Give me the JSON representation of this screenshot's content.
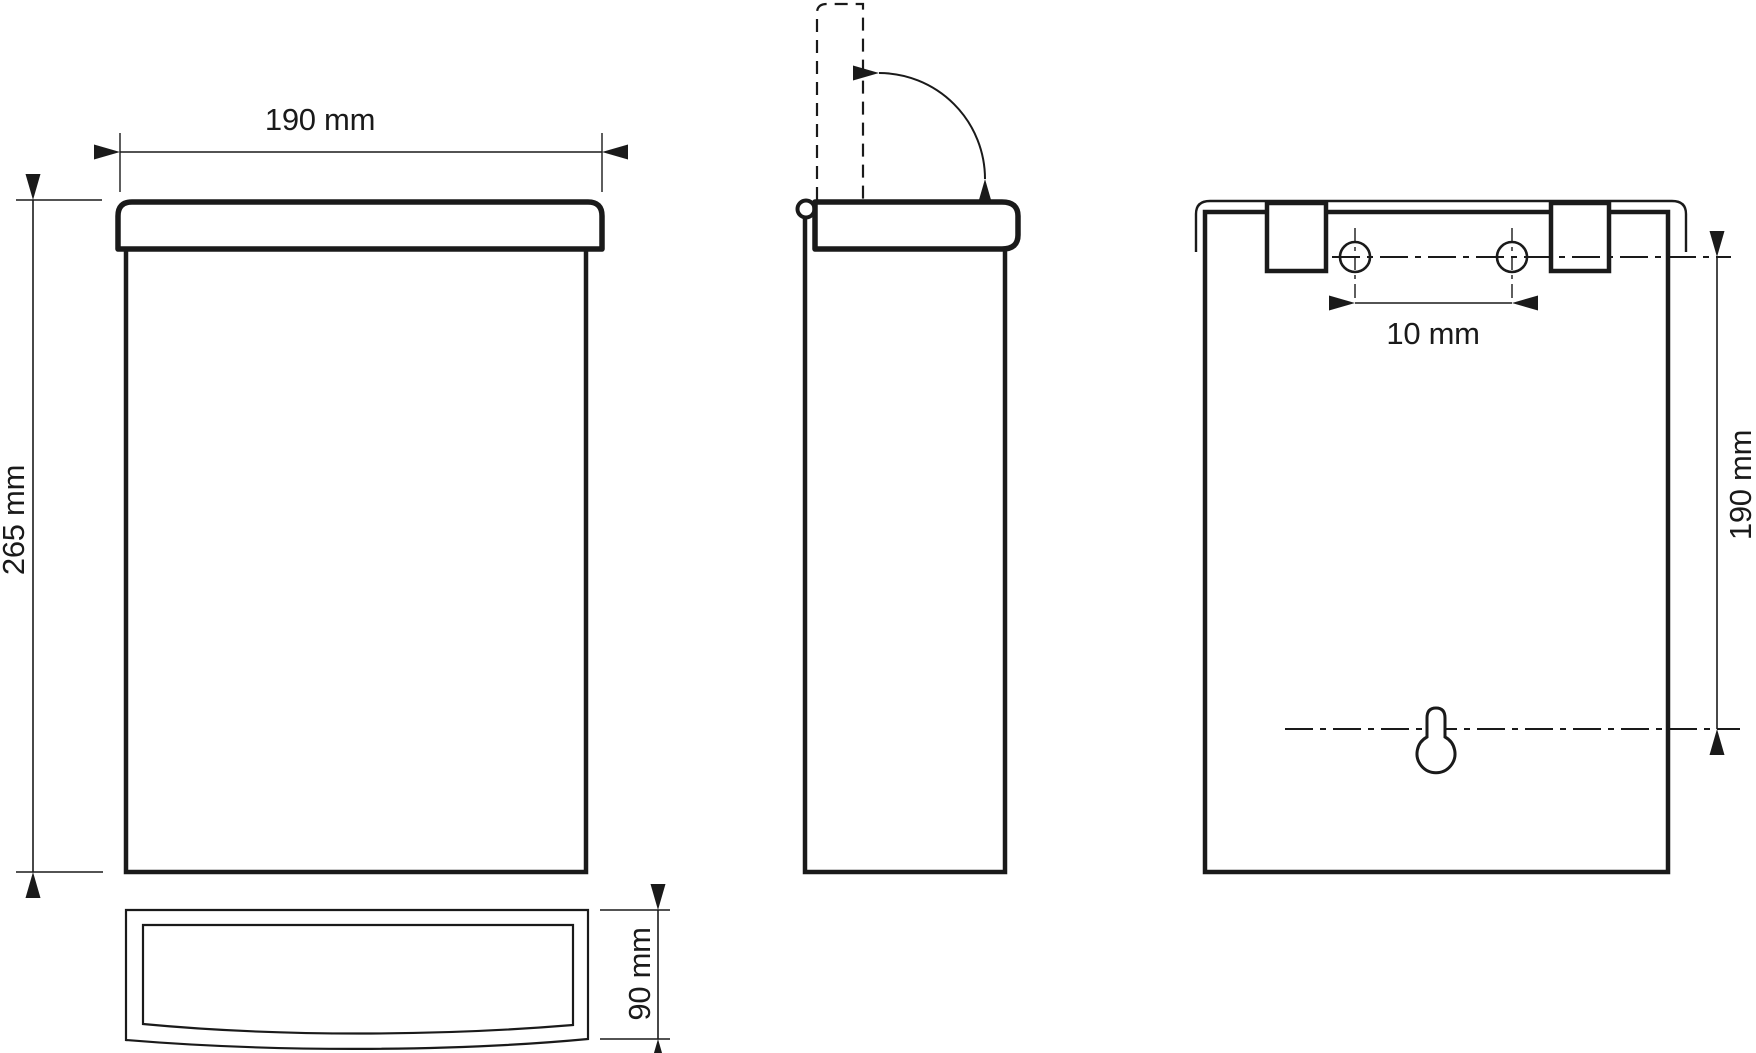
{
  "page": {
    "background": "#ffffff",
    "ink": "#1a1a1a"
  },
  "views": {
    "front": {
      "width_label": "190 mm",
      "height_label": "265 mm"
    },
    "back": {
      "hole_spacing_label": "10 mm",
      "mount_height_label": "190 mm"
    },
    "bottom": {
      "depth_label": "90 mm"
    }
  }
}
